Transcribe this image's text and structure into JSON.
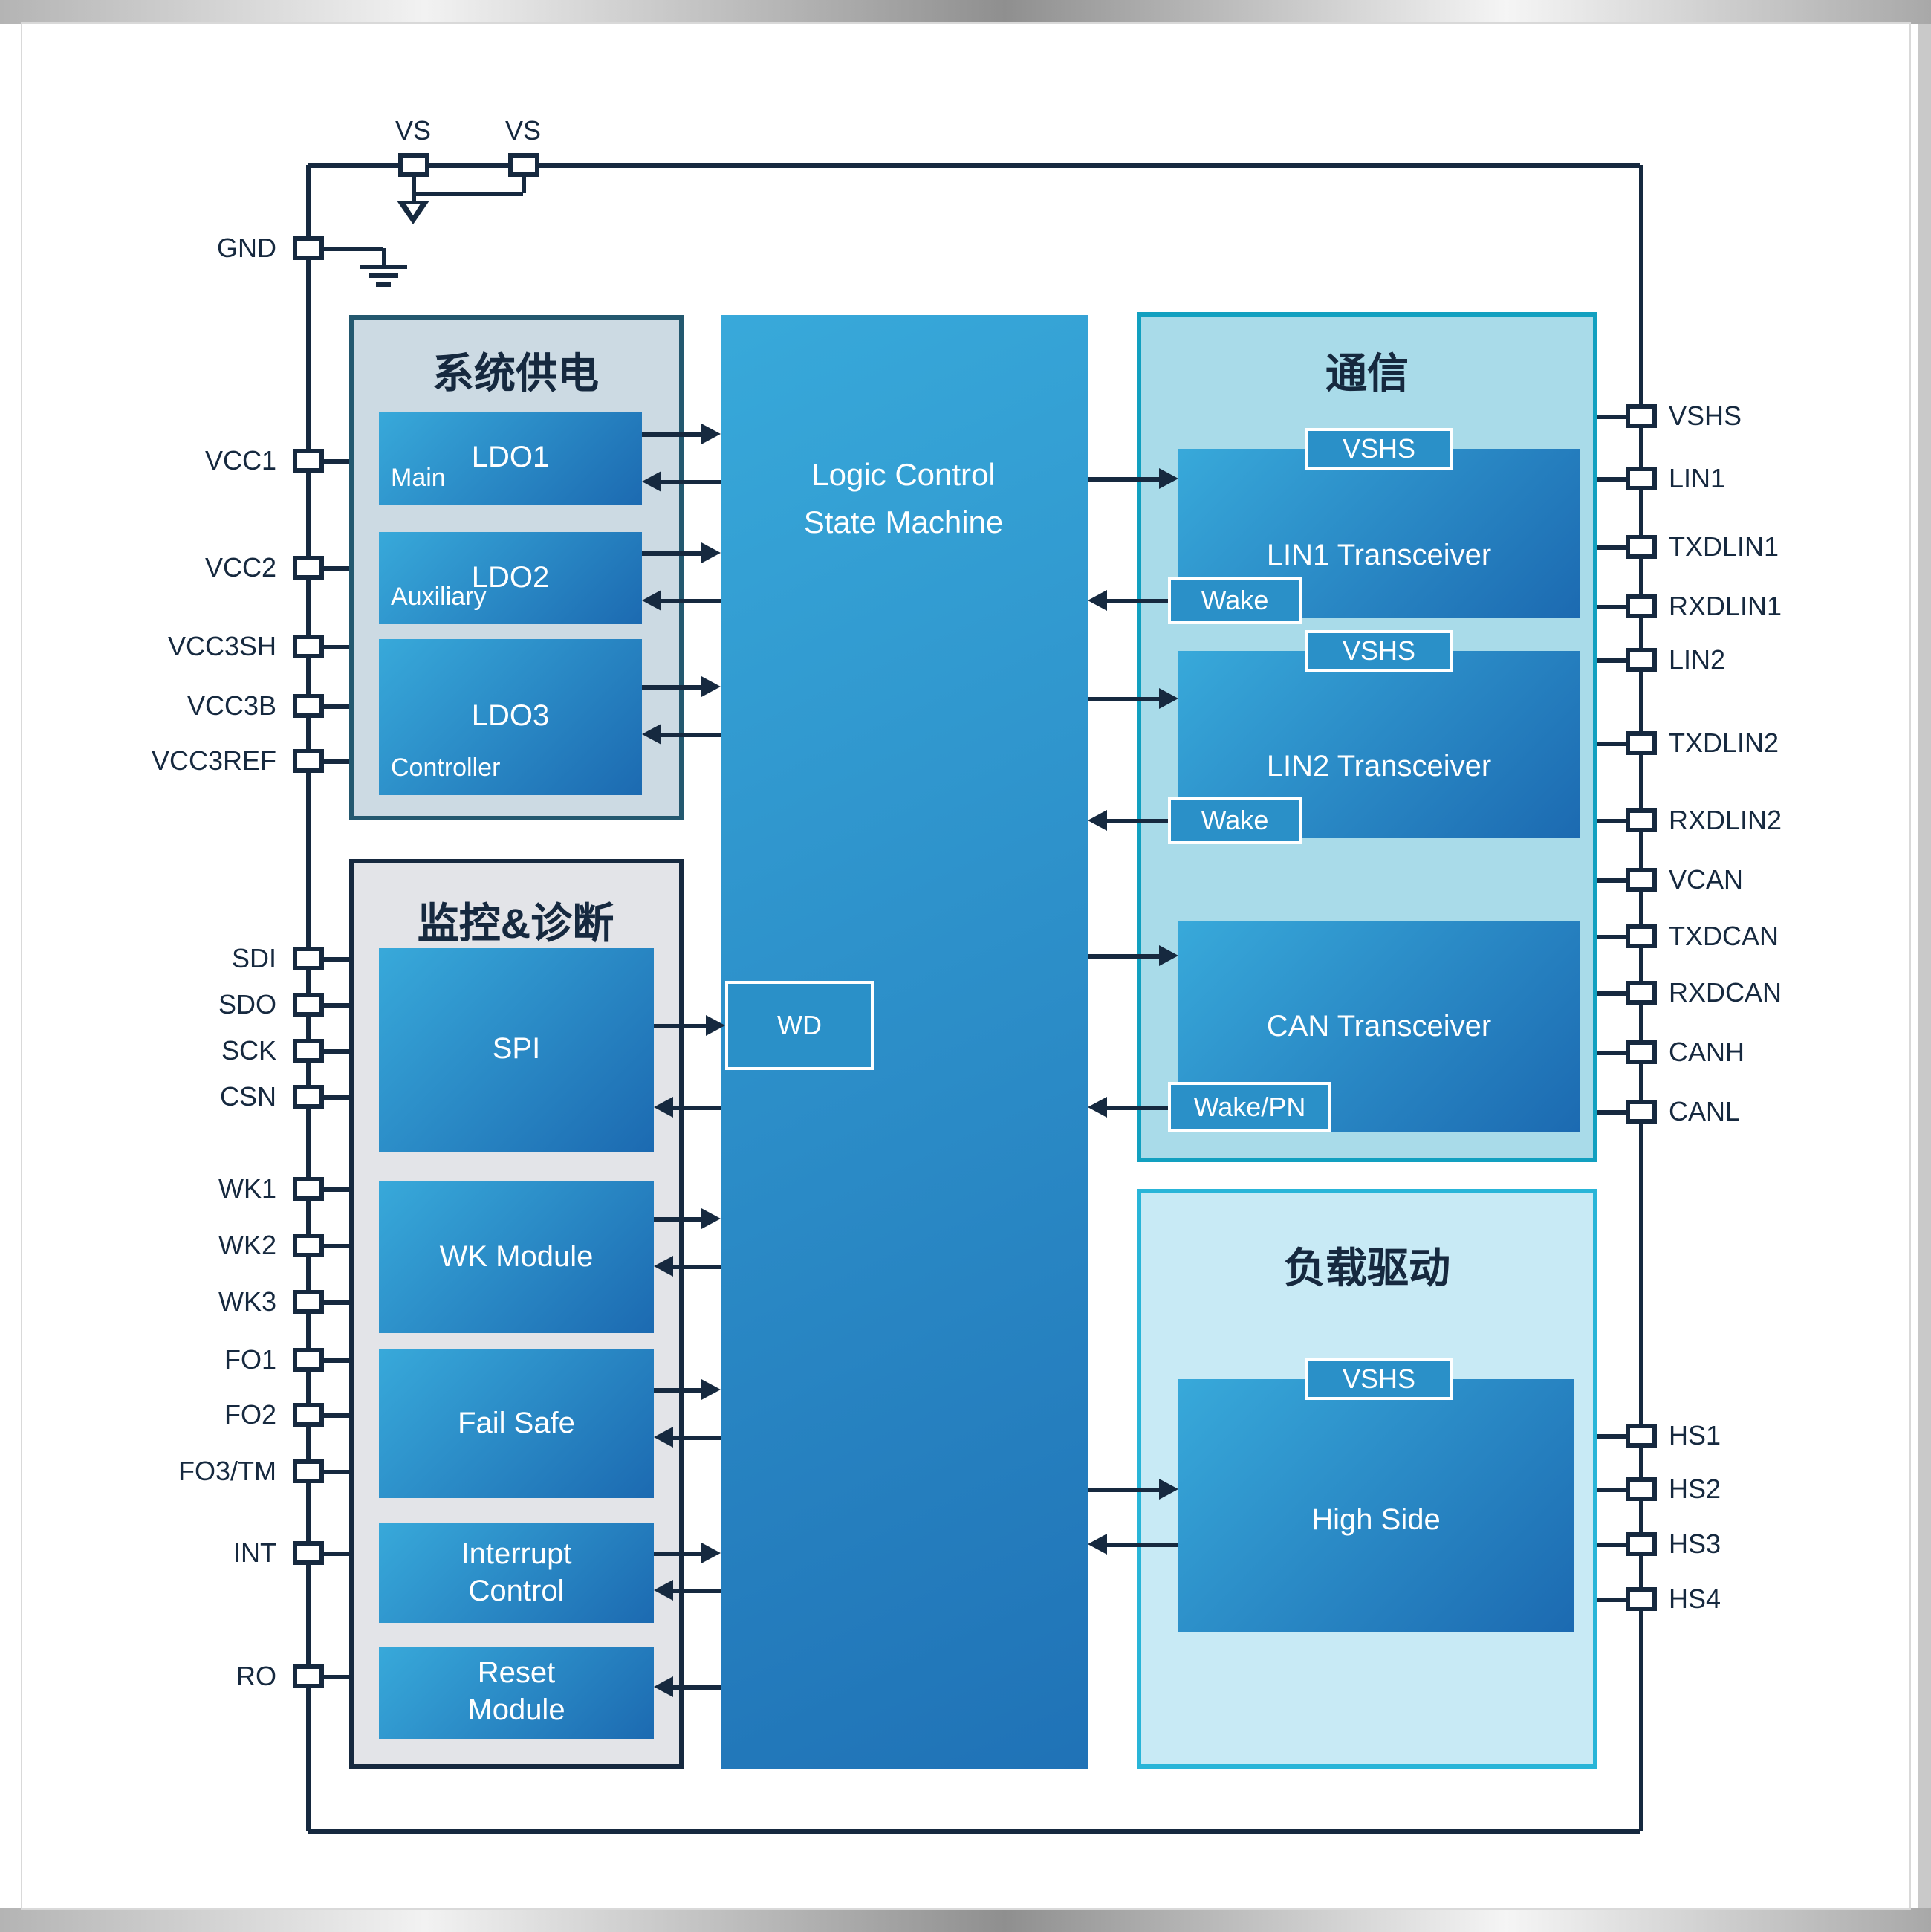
{
  "diagram": {
    "top_pins": [
      "VS",
      "VS"
    ],
    "gnd_label": "GND",
    "left_pins": [
      "VCC1",
      "VCC2",
      "VCC3SH",
      "VCC3B",
      "VCC3REF",
      "SDI",
      "SDO",
      "SCK",
      "CSN",
      "WK1",
      "WK2",
      "WK3",
      "FO1",
      "FO2",
      "FO3/TM",
      "INT",
      "RO"
    ],
    "right_pins": [
      "VSHS",
      "LIN1",
      "TXDLIN1",
      "RXDLIN1",
      "LIN2",
      "TXDLIN2",
      "RXDLIN2",
      "VCAN",
      "TXDCAN",
      "RXDCAN",
      "CANH",
      "CANL",
      "HS1",
      "HS2",
      "HS3",
      "HS4"
    ],
    "power_section": {
      "title": "系统供电",
      "ldo1": {
        "name": "LDO1",
        "role": "Main"
      },
      "ldo2": {
        "name": "LDO2",
        "role": "Auxiliary"
      },
      "ldo3": {
        "name": "LDO3",
        "role": "Controller"
      }
    },
    "monitor_section": {
      "title": "监控&诊断",
      "spi": "SPI",
      "wk": "WK Module",
      "failsafe": "Fail Safe",
      "interrupt": "Interrupt Control",
      "reset": "Reset Module"
    },
    "logic": {
      "title": "Logic Control\nState Machine",
      "watchdog": "WD"
    },
    "comm_section": {
      "title": "通信",
      "lin1": {
        "name": "LIN1 Transceiver",
        "supply_badge": "VSHS",
        "wake_badge": "Wake"
      },
      "lin2": {
        "name": "LIN2 Transceiver",
        "supply_badge": "VSHS",
        "wake_badge": "Wake"
      },
      "can": {
        "name": "CAN Transceiver",
        "wake_badge": "Wake/PN"
      }
    },
    "load_section": {
      "title": "负载驱动",
      "highside": {
        "name": "High Side",
        "supply_badge": "VSHS"
      }
    },
    "colors": {
      "line": "#16293f",
      "module_grad_start": "#38a9da",
      "module_grad_end": "#1c6ab1",
      "badge_fill": "#2a90c8",
      "power_fill": "#ccdae3",
      "power_border": "#23586f",
      "monitor_fill": "#e3e4e8",
      "monitor_border": "#16293f",
      "comm_fill": "#a9dbe9",
      "comm_border": "#12a0c0",
      "load_fill": "#c8eaf5",
      "load_border": "#29b5d8"
    }
  }
}
